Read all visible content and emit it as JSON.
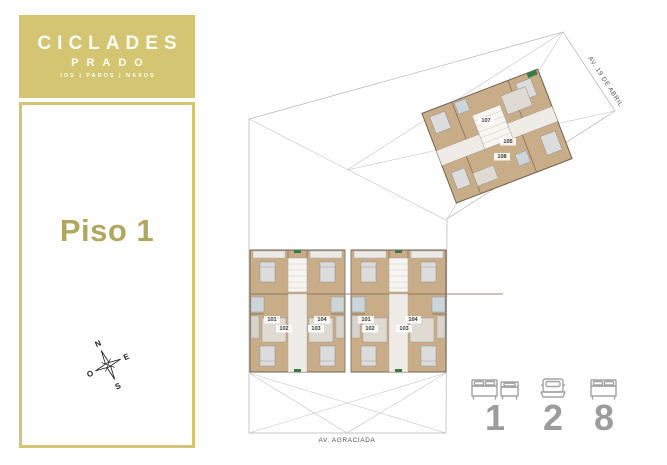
{
  "colors": {
    "brand": "#d3c572",
    "floor_text": "#b1a860",
    "plan_wood": "#c9ad88",
    "plan_wall": "#6f6152",
    "bath_tile": "#ccd5da",
    "accent_green": "#3c7a45",
    "legend_gray": "#9c9c9c"
  },
  "sidebar": {
    "logo": {
      "title": "CICLADES",
      "subtitle": "PRADO",
      "tagline": "IOS | PAROS | NAXOS"
    },
    "floor_label": "Piso 1",
    "compass": {
      "north": "N",
      "east": "E",
      "south": "S",
      "west": "O"
    }
  },
  "site": {
    "streets": {
      "bottom": "AV. AGRACIADA",
      "right": "AV. 19 DE ABRIL"
    },
    "lower_building": {
      "left_block_units": [
        "101",
        "104",
        "102",
        "103"
      ],
      "right_block_units": [
        "101",
        "104",
        "102",
        "103"
      ]
    },
    "rotated_building": {
      "units": [
        "107",
        "105",
        "108"
      ]
    }
  },
  "legend": {
    "items": [
      {
        "icon": "double-and-single-bed-icon",
        "value": "1"
      },
      {
        "icon": "car-icon",
        "value": "2"
      },
      {
        "icon": "double-bed-icon",
        "value": "8"
      }
    ]
  }
}
